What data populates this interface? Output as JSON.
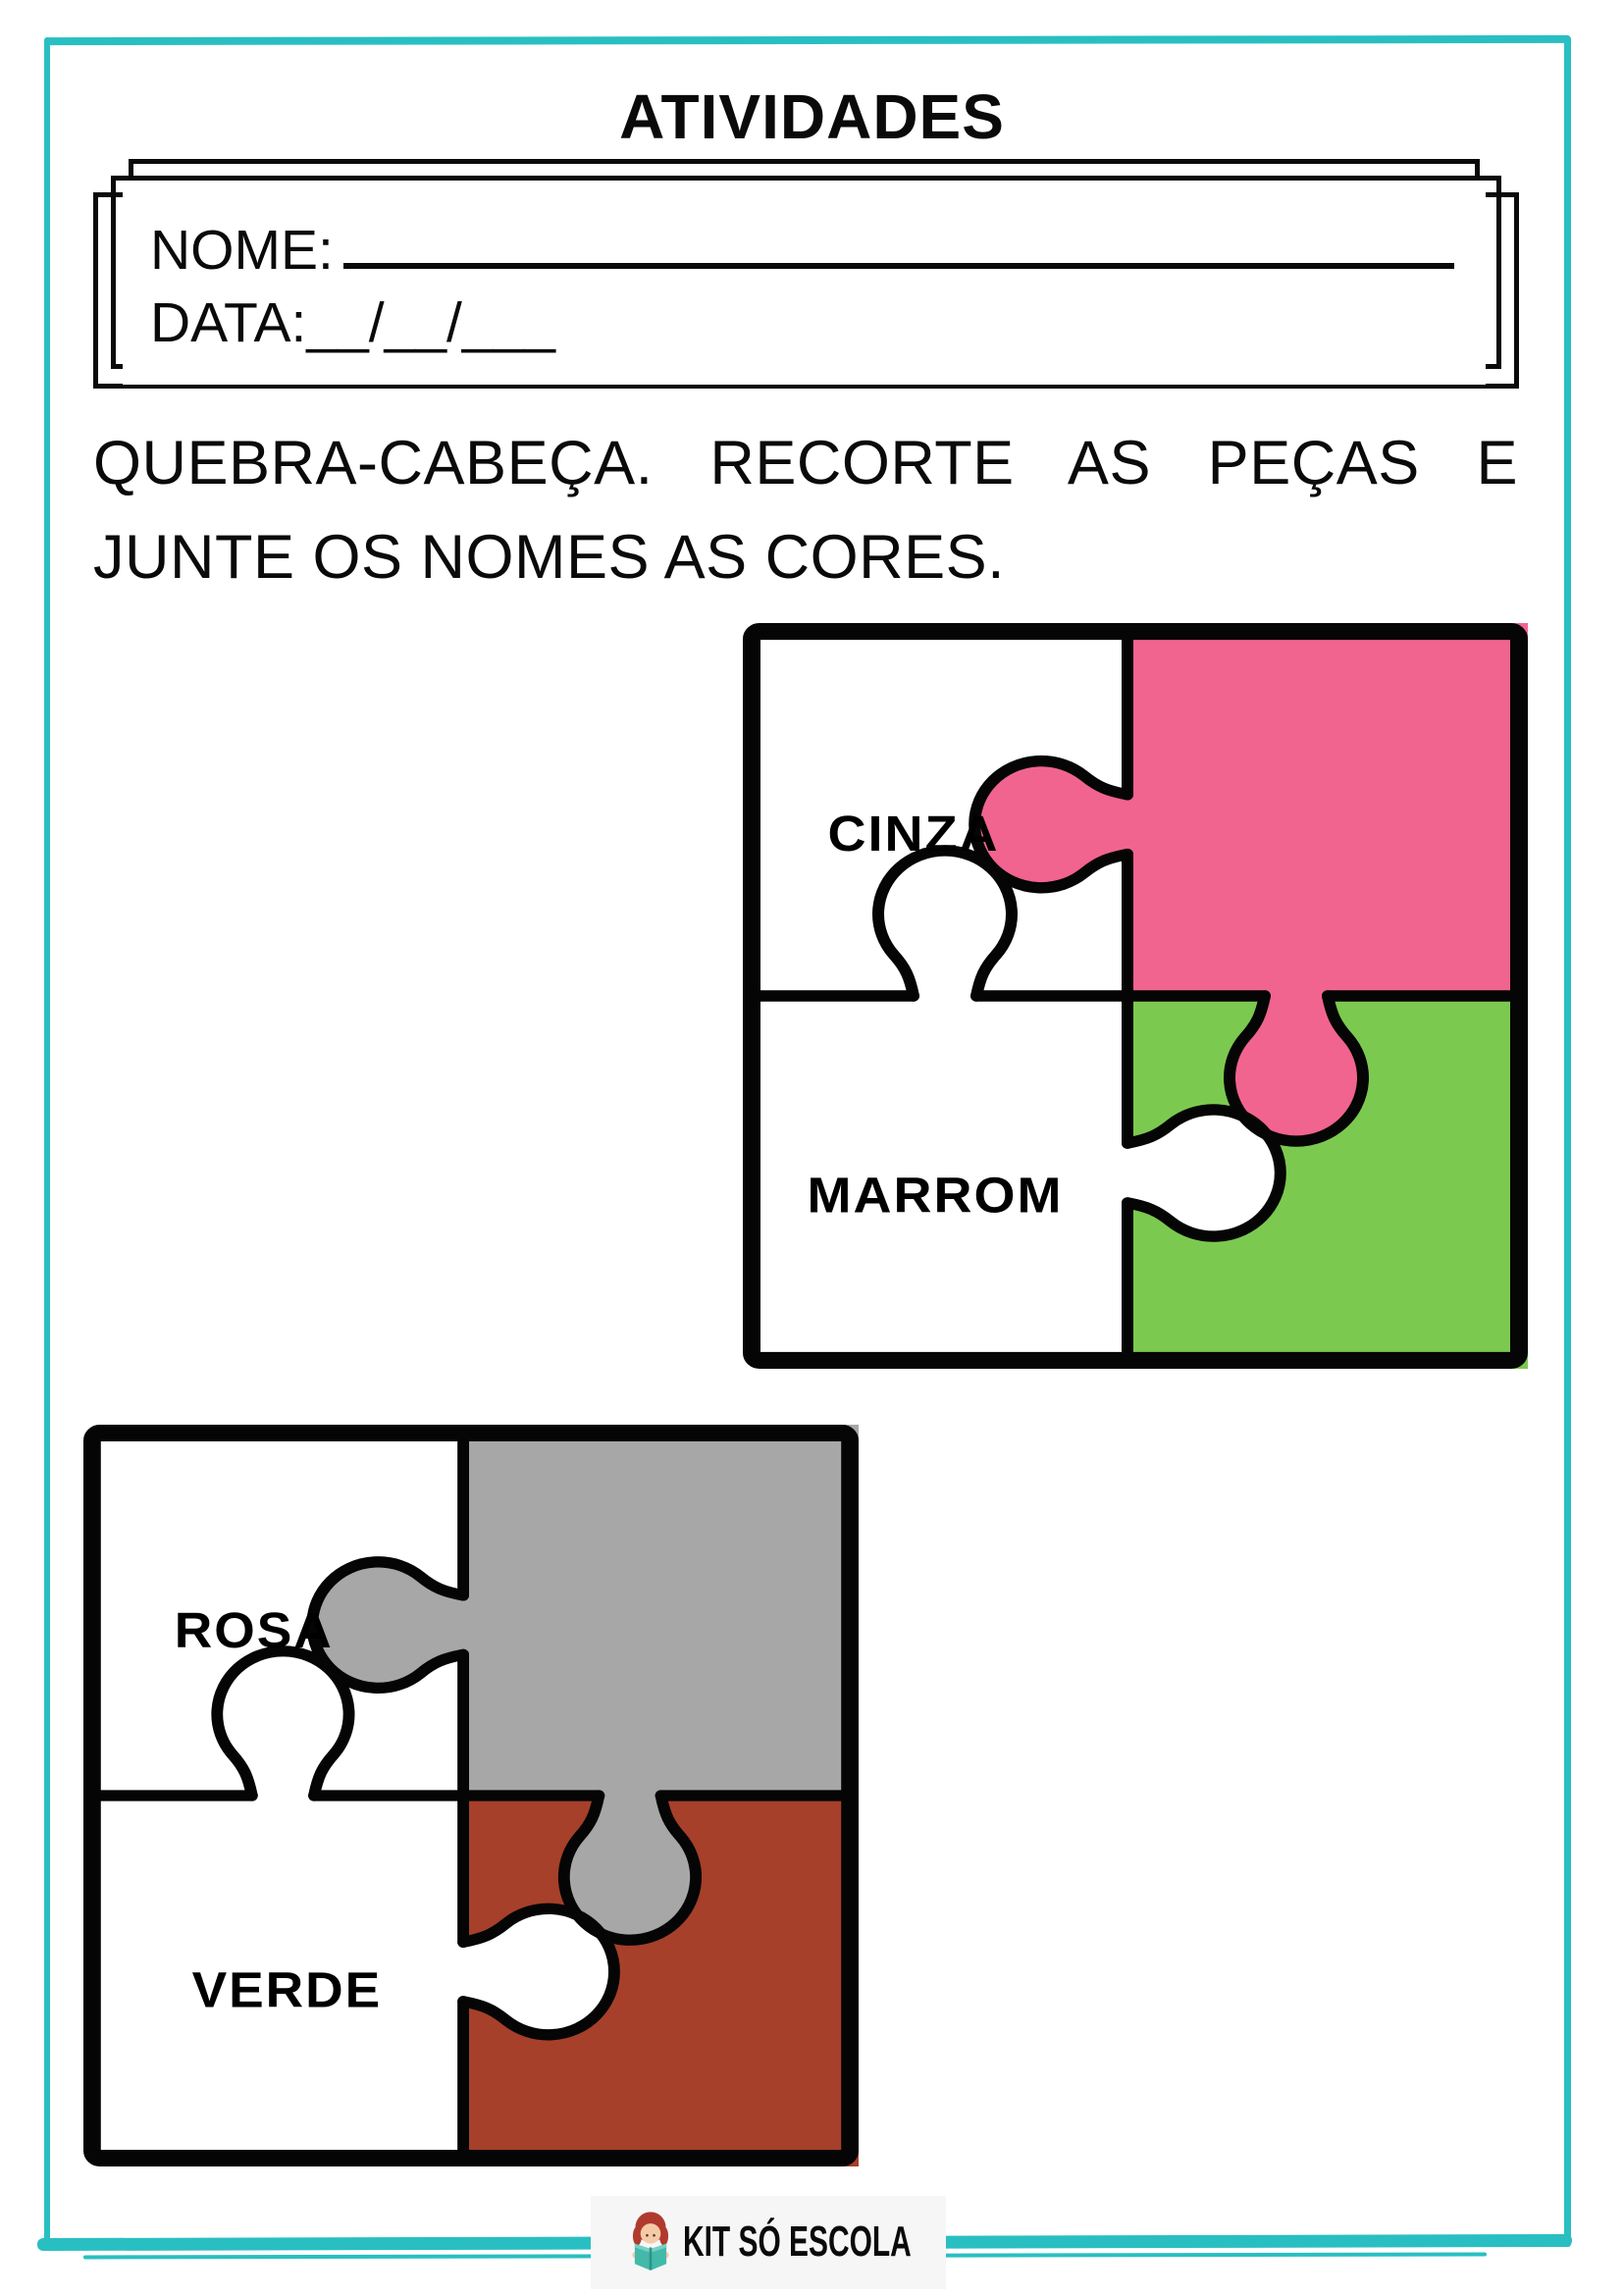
{
  "page": {
    "title": "ATIVIDADES",
    "border_color": "#29bfc2"
  },
  "header_box": {
    "name_label": "NOME:",
    "date_label": "DATA:",
    "date_blanks": "__/__/___"
  },
  "instructions": {
    "line1": "QUEBRA-CABEÇA. RECORTE AS PEÇAS E",
    "line2": "JUNTE OS NOMES AS CORES."
  },
  "puzzles": [
    {
      "labels": {
        "top_left": "CINZA",
        "bottom_left": "MARROM"
      },
      "colors": {
        "top_left": "#ffffff",
        "top_right": "#f1648f",
        "bottom_left": "#ffffff",
        "bottom_right": "#7cc950",
        "outline": "#050505"
      }
    },
    {
      "labels": {
        "top_left": "ROSA",
        "bottom_left": "VERDE"
      },
      "colors": {
        "top_left": "#ffffff",
        "top_right": "#a7a7a7",
        "bottom_left": "#ffffff",
        "bottom_right": "#a6402a",
        "outline": "#050505"
      }
    }
  ],
  "footer": {
    "brand": "KIT SÓ ESCOLA",
    "logo_icon": "child-reading-book",
    "logo_bg": "#f6f6f6",
    "book_color": "#43b9a9",
    "book_dark": "#2d9488",
    "hair_color": "#b03a2e",
    "skin_color": "#f5cba7"
  }
}
